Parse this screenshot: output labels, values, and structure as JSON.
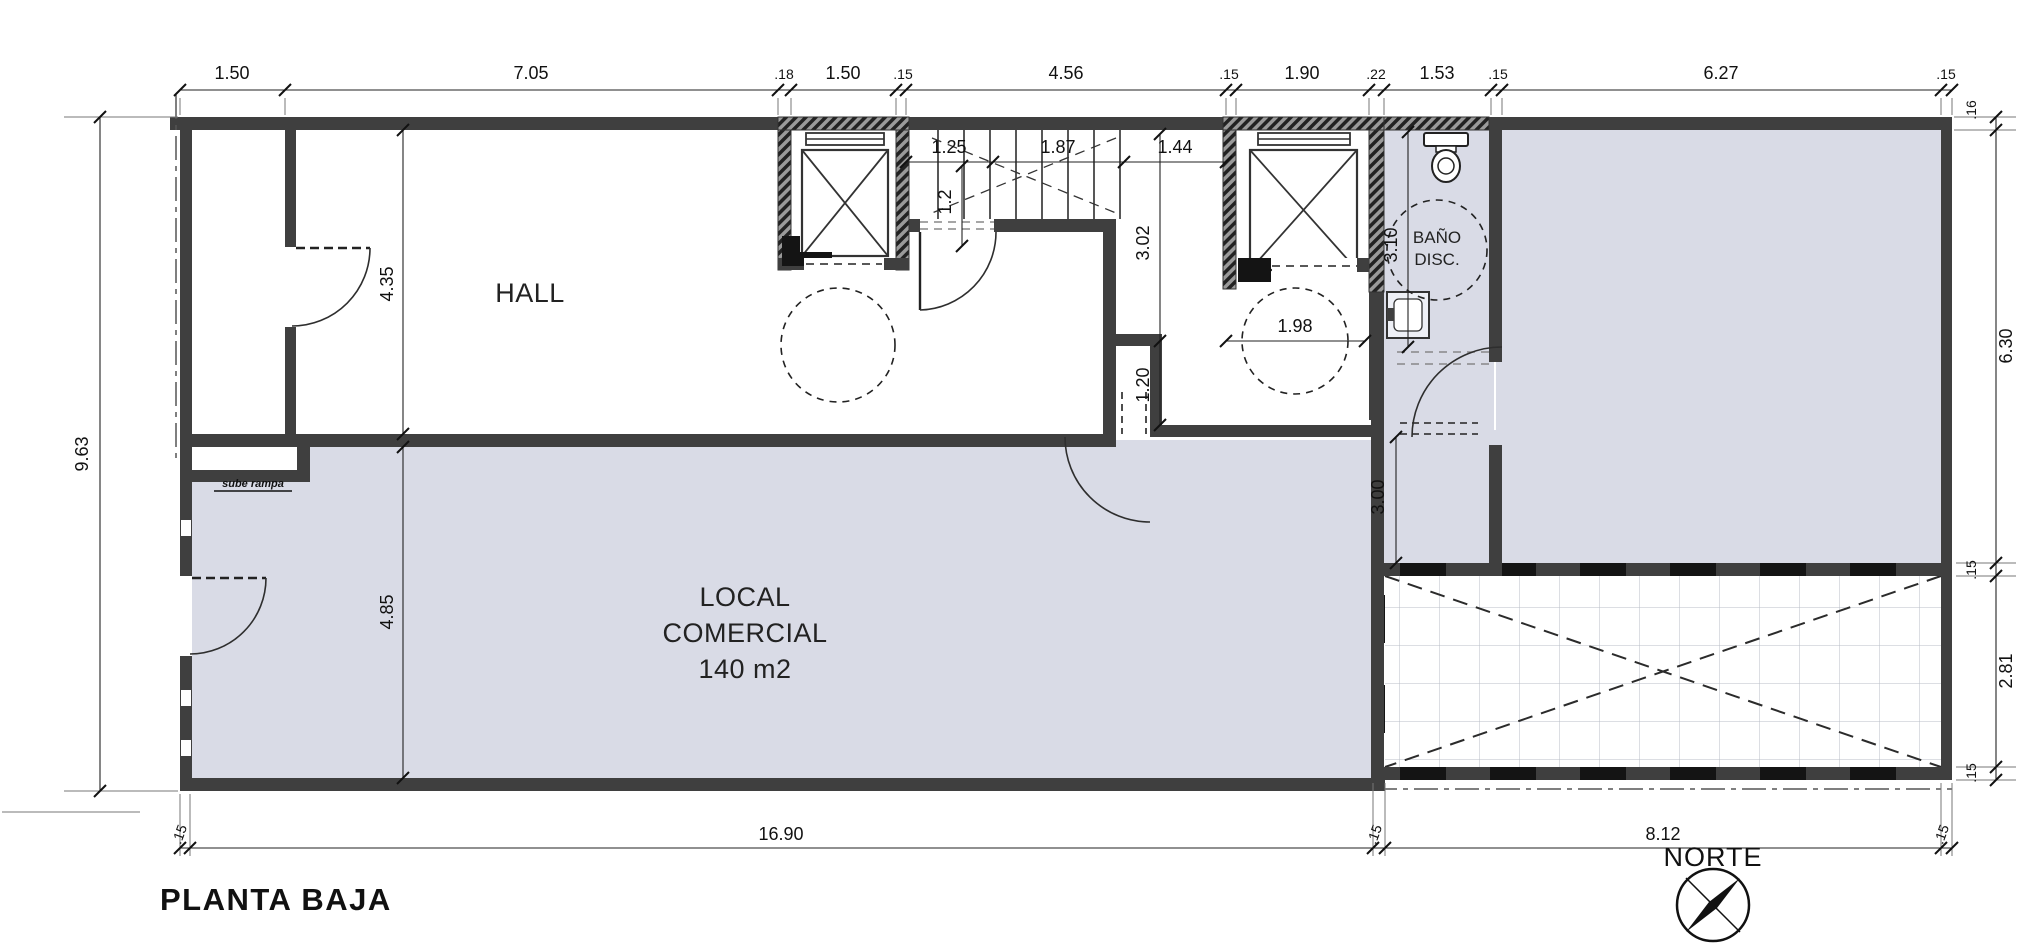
{
  "title": "PLANTA BAJA",
  "north": {
    "label": "NORTE"
  },
  "rooms": {
    "hall": "HALL",
    "local1": "LOCAL",
    "local2": "COMERCIAL",
    "local3": "140 m2",
    "bano1": "BAÑO",
    "bano2": "DISC."
  },
  "annotation": {
    "step_note": "sube rampa"
  },
  "dims": {
    "top": [
      "1.50",
      "7.05",
      ".18",
      "1.50",
      ".15",
      "4.56",
      ".15",
      "1.90",
      ".22",
      "1.53",
      ".15",
      "6.27",
      ".15"
    ],
    "bottom": [
      ".15",
      "16.90",
      ".15",
      "8.12",
      ".15"
    ],
    "left": [
      "9.63"
    ],
    "right": [
      ".16",
      "6.30",
      ".15",
      "2.81",
      ".15"
    ],
    "interior": {
      "hall_height": "4.35",
      "local_height": "4.85",
      "stair_a": "1.25",
      "stair_b": "1.87",
      "stair_c": "1.44",
      "stair_d": "1.2",
      "stair_depth": "3.02",
      "door_offset": "1.20",
      "turn_radius": "1.98",
      "bano_depth": "3.10",
      "passage": "3.00"
    }
  },
  "colors": {
    "wall": "#3f3f3f",
    "room_fill": "#d9dbe6",
    "title": "#1e3a6c"
  }
}
